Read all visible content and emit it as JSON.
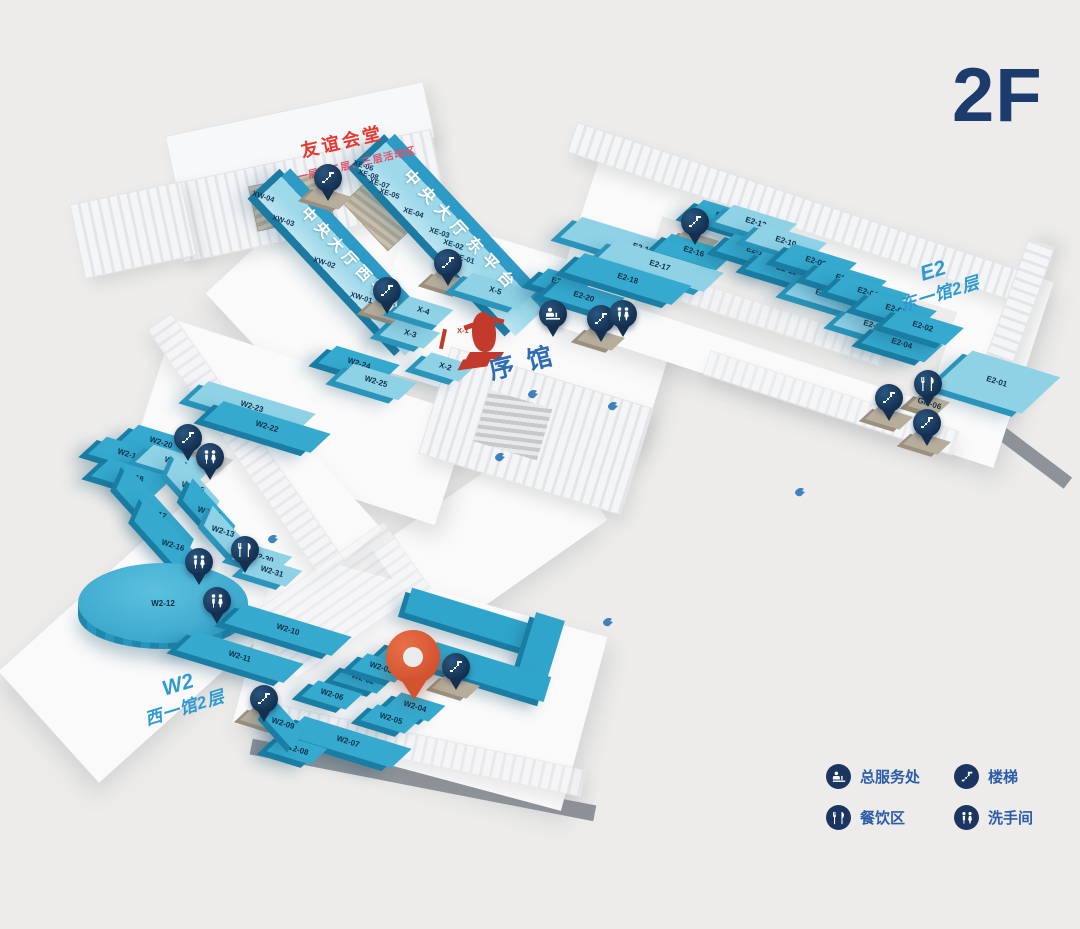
{
  "title": "2F",
  "areas": {
    "friendship_hall": {
      "name": "友谊会堂",
      "subtitle": "一层、二层、三层活动区"
    },
    "west_platform": "中央大厅西平台",
    "east_platform": "中央大厅东平台",
    "intro_hall": "序馆",
    "east_wing": {
      "code": "E2",
      "name": "东一馆2层"
    },
    "west_wing": {
      "code": "W2",
      "name": "西一馆2层"
    }
  },
  "legend": [
    {
      "icon": "service-desk",
      "label": "总服务处"
    },
    {
      "icon": "stairs",
      "label": "楼梯"
    },
    {
      "icon": "dining",
      "label": "餐饮区"
    },
    {
      "icon": "restroom",
      "label": "洗手间"
    }
  ],
  "colors": {
    "background": "#edecea",
    "booth_teal": "#35a9ce",
    "booth_light": "#8fd2e6",
    "pin_navy": "#1b3a63",
    "location_pin": "#d3532f",
    "title_navy": "#1d3c6e",
    "legend_blue": "#2d5ca9",
    "art_red": "#c23a2c"
  },
  "booths": [
    {
      "id": "X-1",
      "x": 467,
      "y": 330,
      "k": "red"
    },
    {
      "id": "X-2",
      "x": 445,
      "y": 367,
      "k": "s lt"
    },
    {
      "id": "X-3",
      "x": 410,
      "y": 334,
      "k": "s lt"
    },
    {
      "id": "X-4",
      "x": 423,
      "y": 311,
      "k": "s lt"
    },
    {
      "id": "X-5",
      "x": 495,
      "y": 291,
      "k": "m lt"
    },
    {
      "id": "E2-19",
      "x": 562,
      "y": 283,
      "k": "s"
    },
    {
      "id": "E2-20",
      "x": 584,
      "y": 297,
      "k": "m"
    },
    {
      "id": "E2-15",
      "x": 643,
      "y": 249,
      "k": "xl lt"
    },
    {
      "id": "E2-16",
      "x": 694,
      "y": 252,
      "k": "m"
    },
    {
      "id": "E2-17",
      "x": 660,
      "y": 266,
      "k": "l lt"
    },
    {
      "id": "E2-18",
      "x": 628,
      "y": 279,
      "k": "l"
    },
    {
      "id": "E2-14",
      "x": 726,
      "y": 218,
      "k": "m"
    },
    {
      "id": "E2-13",
      "x": 756,
      "y": 223,
      "k": "m lt"
    },
    {
      "id": "E2-12",
      "x": 757,
      "y": 252,
      "k": "m"
    },
    {
      "id": "E2-10",
      "x": 786,
      "y": 242,
      "k": "m lt"
    },
    {
      "id": "E2-11",
      "x": 786,
      "y": 270,
      "k": "m"
    },
    {
      "id": "E2-09",
      "x": 816,
      "y": 262,
      "k": "m"
    },
    {
      "id": "E2-08",
      "x": 826,
      "y": 295,
      "k": "m lt"
    },
    {
      "id": "E2-07",
      "x": 846,
      "y": 280,
      "k": "m"
    },
    {
      "id": "E2-06",
      "x": 868,
      "y": 293,
      "k": "m"
    },
    {
      "id": "E2-05",
      "x": 874,
      "y": 326,
      "k": "m lt"
    },
    {
      "id": "E2-03",
      "x": 896,
      "y": 310,
      "k": "m"
    },
    {
      "id": "E2-04",
      "x": 902,
      "y": 344,
      "k": "m"
    },
    {
      "id": "E2-02",
      "x": 923,
      "y": 327,
      "k": "m"
    },
    {
      "id": "E2-01",
      "x": 997,
      "y": 382,
      "k": "big lt"
    },
    {
      "id": "GM-06",
      "x": 929,
      "y": 404,
      "k": "tan"
    },
    {
      "id": "W2-23",
      "x": 252,
      "y": 407,
      "k": "l lt"
    },
    {
      "id": "W2-22",
      "x": 267,
      "y": 427,
      "k": "l"
    },
    {
      "id": "W2-24",
      "x": 359,
      "y": 364,
      "k": "m"
    },
    {
      "id": "W2-25",
      "x": 376,
      "y": 382,
      "k": "m lt"
    },
    {
      "id": "W2-20",
      "x": 161,
      "y": 443,
      "k": "m"
    },
    {
      "id": "W2-19",
      "x": 129,
      "y": 455,
      "k": "m"
    },
    {
      "id": "W2-21",
      "x": 176,
      "y": 463,
      "k": "m lt"
    },
    {
      "id": "W2-18",
      "x": 132,
      "y": 477,
      "k": "m"
    },
    {
      "id": "W2-15",
      "x": 193,
      "y": 488,
      "k": "mv lt"
    },
    {
      "id": "W2-17",
      "x": 155,
      "y": 514,
      "k": "lv"
    },
    {
      "id": "W2-14",
      "x": 209,
      "y": 513,
      "k": "mv"
    },
    {
      "id": "W2-13",
      "x": 223,
      "y": 532,
      "k": "sv lt"
    },
    {
      "id": "W2-16",
      "x": 173,
      "y": 546,
      "k": "lv"
    },
    {
      "id": "W2-30",
      "x": 262,
      "y": 558,
      "k": "s lt"
    },
    {
      "id": "W2-31",
      "x": 272,
      "y": 572,
      "k": "s lt"
    },
    {
      "id": "W2-12",
      "x": 163,
      "y": 608,
      "k": "circle"
    },
    {
      "id": "W2-10",
      "x": 288,
      "y": 630,
      "k": "l"
    },
    {
      "id": "W2-11",
      "x": 240,
      "y": 657,
      "k": "l"
    },
    {
      "id": "W2-01",
      "x": 408,
      "y": 656,
      "k": "s"
    },
    {
      "id": "W2-02",
      "x": 363,
      "y": 679,
      "k": "s"
    },
    {
      "id": "W2-03",
      "x": 381,
      "y": 668,
      "k": "s"
    },
    {
      "id": "W2-04",
      "x": 415,
      "y": 707,
      "k": "s"
    },
    {
      "id": "W2-05",
      "x": 391,
      "y": 719,
      "k": "s"
    },
    {
      "id": "W2-06",
      "x": 332,
      "y": 695,
      "k": "s"
    },
    {
      "id": "W2-07",
      "x": 348,
      "y": 742,
      "k": "l"
    },
    {
      "id": "W2-08",
      "x": 297,
      "y": 750,
      "k": "s"
    },
    {
      "id": "W2-09",
      "x": 283,
      "y": 724,
      "k": "sv"
    }
  ],
  "ramp_labels": [
    {
      "id": "XW-04",
      "x": 266,
      "y": 196
    },
    {
      "id": "XW-03",
      "x": 286,
      "y": 220
    },
    {
      "id": "XW-02",
      "x": 327,
      "y": 262
    },
    {
      "id": "XW-01",
      "x": 364,
      "y": 297
    },
    {
      "id": "XE-06",
      "x": 367,
      "y": 165
    },
    {
      "id": "XE-08",
      "x": 372,
      "y": 174
    },
    {
      "id": "XE-07",
      "x": 383,
      "y": 183
    },
    {
      "id": "XE-05",
      "x": 393,
      "y": 193
    },
    {
      "id": "XE-04",
      "x": 417,
      "y": 212
    },
    {
      "id": "XE-03",
      "x": 443,
      "y": 232
    },
    {
      "id": "XE-02",
      "x": 457,
      "y": 244
    },
    {
      "id": "XE-01",
      "x": 468,
      "y": 258
    }
  ],
  "pins": [
    {
      "t": "stairs",
      "x": 328,
      "y": 178
    },
    {
      "t": "stairs",
      "x": 387,
      "y": 291
    },
    {
      "t": "stairs",
      "x": 448,
      "y": 263
    },
    {
      "t": "stairs",
      "x": 695,
      "y": 222
    },
    {
      "t": "service-desk",
      "x": 553,
      "y": 314
    },
    {
      "t": "stairs",
      "x": 601,
      "y": 319
    },
    {
      "t": "restroom",
      "x": 623,
      "y": 314
    },
    {
      "t": "stairs",
      "x": 188,
      "y": 438
    },
    {
      "t": "restroom",
      "x": 210,
      "y": 457
    },
    {
      "t": "dining",
      "x": 245,
      "y": 550
    },
    {
      "t": "restroom",
      "x": 199,
      "y": 562
    },
    {
      "t": "restroom",
      "x": 217,
      "y": 601
    },
    {
      "t": "stairs",
      "x": 264,
      "y": 699
    },
    {
      "t": "stairs",
      "x": 456,
      "y": 667
    },
    {
      "t": "dining",
      "x": 928,
      "y": 384
    },
    {
      "t": "stairs",
      "x": 889,
      "y": 398
    },
    {
      "t": "stairs",
      "x": 927,
      "y": 423
    }
  ],
  "floor_markers": [
    [
      533,
      392
    ],
    [
      613,
      404
    ],
    [
      500,
      455
    ],
    [
      800,
      490
    ],
    [
      608,
      620
    ],
    [
      273,
      537
    ]
  ],
  "current_location": {
    "x": 413,
    "y": 660,
    "booth": "W2-04"
  }
}
